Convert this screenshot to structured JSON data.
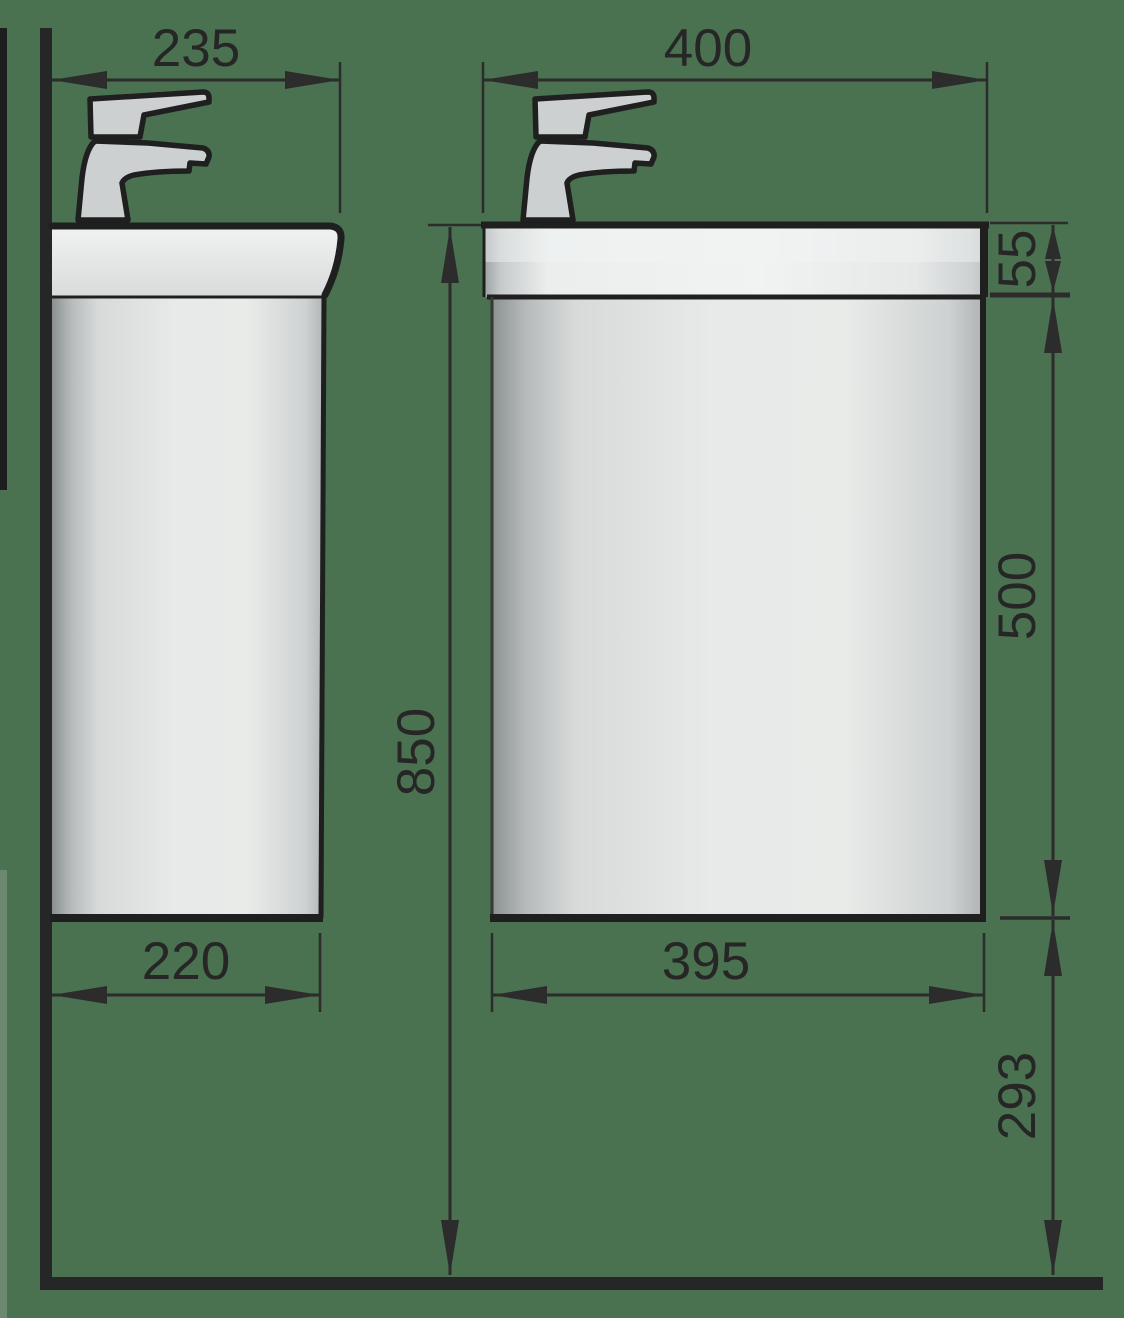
{
  "drawing": {
    "title": "Wall-hung washbasin vanity unit — dimensional drawing (side view and front view)",
    "units": "mm",
    "views": {
      "left": "side view",
      "right": "front view"
    },
    "colors": {
      "background": "#4a7150",
      "outline": "#1f1f1f",
      "dimension_line": "#2c2c2c",
      "surface_light": "#e9ebe9",
      "surface_dark": "#8a9090"
    }
  },
  "dimensions": {
    "side_depth_top": "235",
    "side_depth_bottom": "220",
    "front_width_top": "400",
    "front_width_bottom": "395",
    "basin_height": "55",
    "cabinet_height": "500",
    "total_rim_height": "850",
    "clearance_below": "293"
  }
}
